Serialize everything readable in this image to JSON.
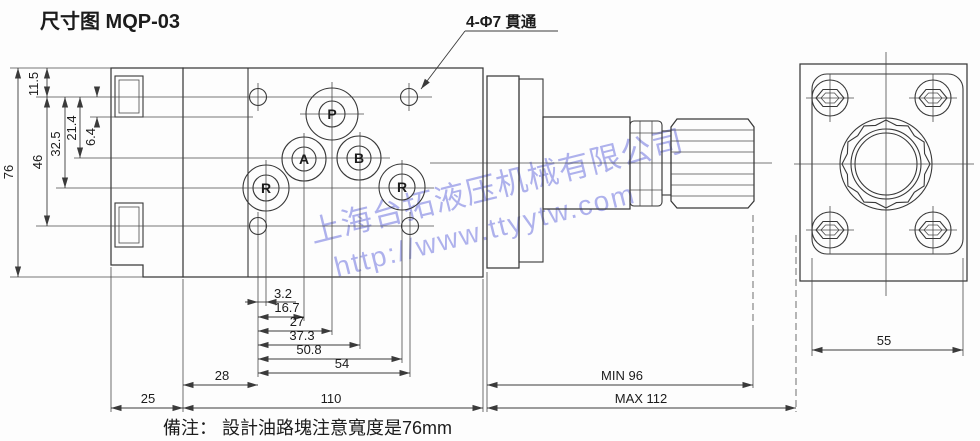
{
  "page": {
    "title": "尺寸图 MQP-03",
    "note": "備注： 設計油路塊注意寬度是76mm"
  },
  "callout": {
    "label": "4-Φ7 貫通"
  },
  "main_view": {
    "ports": {
      "p": "P",
      "a": "A",
      "b": "B",
      "r_left": "R",
      "r_right": "R"
    }
  },
  "dims": {
    "left": {
      "h76": "76",
      "h46": "46",
      "h32_5": "32.5",
      "h21_4": "21.4",
      "h6_4": "6.4",
      "h11_5": "11.5"
    },
    "bottom": {
      "w3_2": "3.2",
      "w16_7": "16.7",
      "w27": "27",
      "w37_3": "37.3",
      "w50_8": "50.8",
      "w54": "54",
      "w28": "28",
      "w25": "25",
      "w110": "110",
      "min": "MIN 96",
      "max": "MAX 112"
    },
    "side": {
      "w55": "55"
    }
  },
  "watermark": {
    "line1": "上海台拓液压机械有限公司",
    "line2": "http://www.ttyytw.com",
    "color": "#7b80e2"
  },
  "colors": {
    "background": "#fdfdfd",
    "line": "#383838",
    "watermark": "#7b80e2"
  }
}
